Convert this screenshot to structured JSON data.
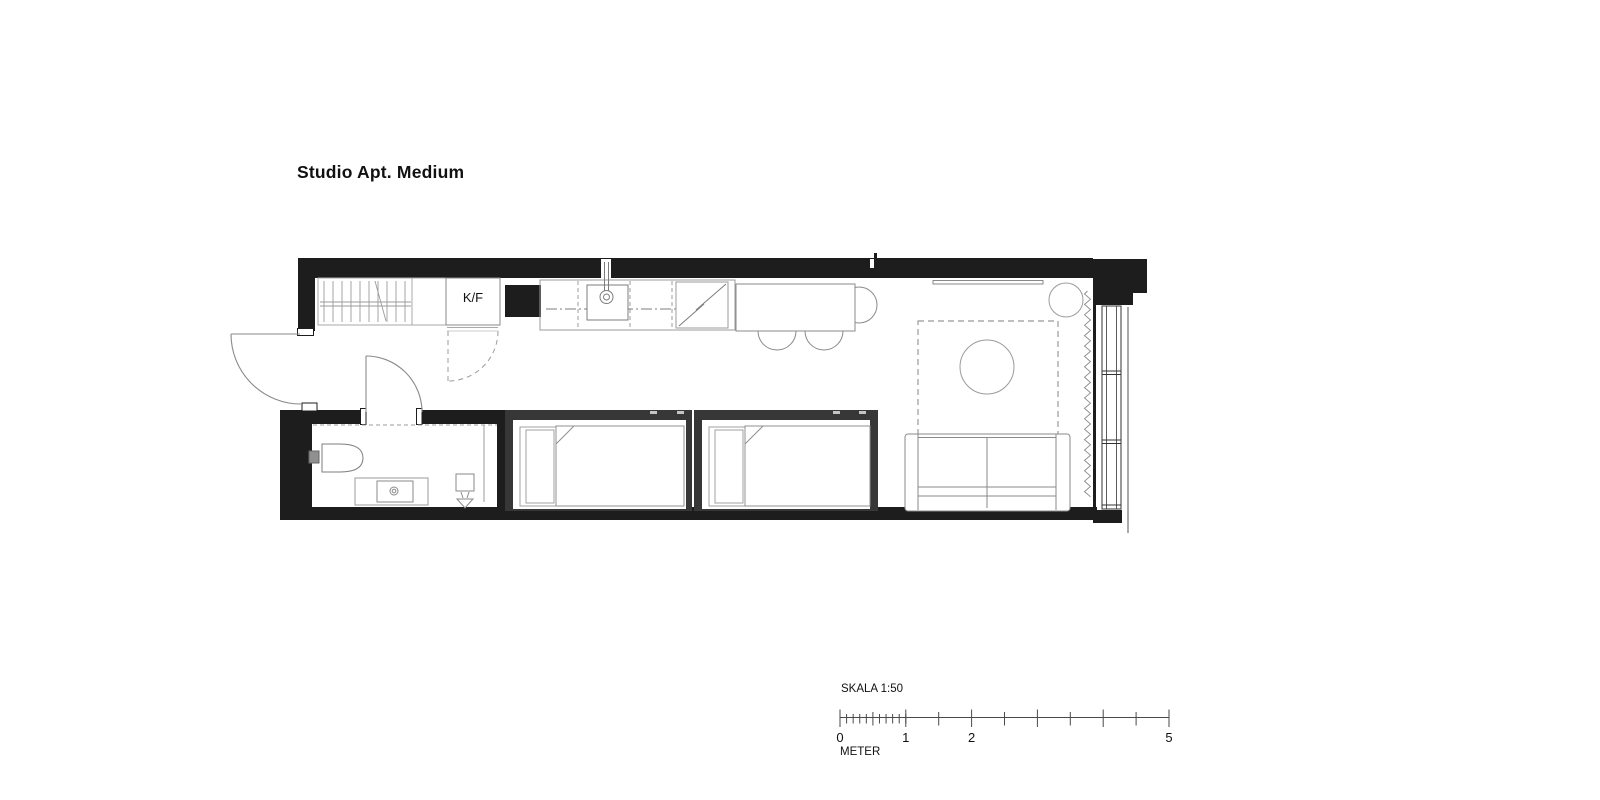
{
  "title": "Studio Apt. Medium",
  "floor_plan": {
    "unit_label": "K/F",
    "elements": [
      "exterior-walls",
      "entry-door",
      "wardrobe",
      "fridge-freezer",
      "kitchen-counter",
      "kitchen-sink",
      "kitchen-appliance",
      "dining-table",
      "dining-chairs",
      "wall-shelf",
      "plant",
      "rug",
      "coffee-table",
      "sofa",
      "curtain",
      "window",
      "bed-1",
      "bed-2",
      "bathroom",
      "toilet",
      "vanity-sink",
      "floor-drain",
      "bathroom-door",
      "wardrobe-door-swing"
    ]
  },
  "scale_bar": {
    "label": "SKALA 1:50",
    "unit": "METER",
    "ticks": [
      {
        "value": 0,
        "label": "0"
      },
      {
        "value": 1,
        "label": "1"
      },
      {
        "value": 2,
        "label": "2"
      },
      {
        "value": 5,
        "label": "5"
      }
    ],
    "total_meters": 5,
    "half_tick_interval_m": 0.5,
    "minor_ticks_per_meter": 10
  },
  "colors": {
    "wall": "#1d1d1d",
    "bed_frame": "#373737",
    "furniture_line": "#8a8a8a",
    "light_line": "#a9a9a9",
    "window_line": "#333333",
    "ruler_line": "#4a4a4a",
    "text": "#111111",
    "background": "#ffffff"
  }
}
